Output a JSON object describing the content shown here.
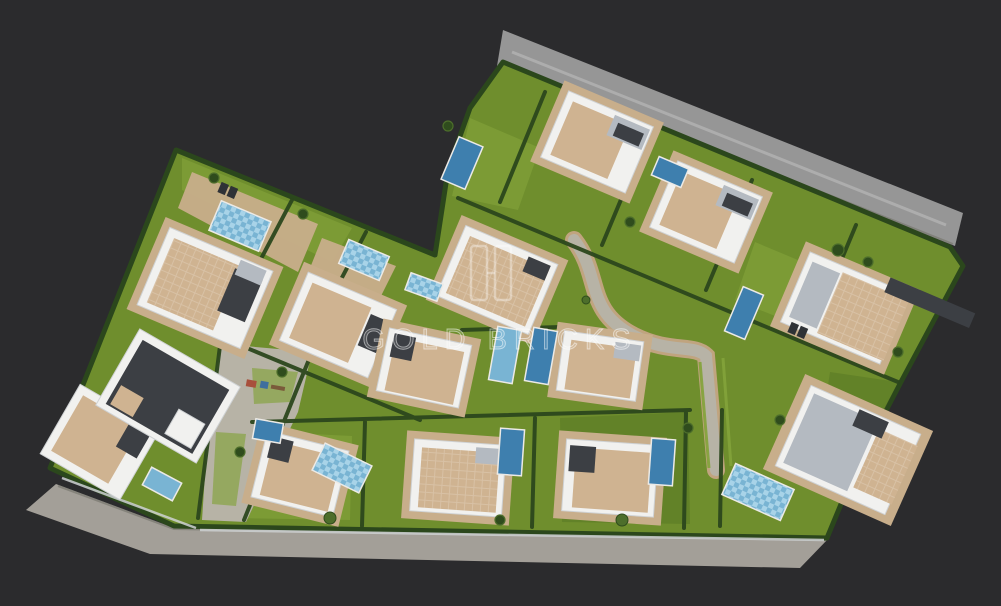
{
  "watermark": {
    "brand_text": "GOLD BRICKS",
    "emblem": "gold-bricks-monogram"
  },
  "scene": {
    "type": "aerial-3d-architectural-render",
    "subject": "Bird's-eye render of a gated residential development of modern white villas",
    "features": [
      "white villas with tiled terraces",
      "private swimming pools",
      "lawned gardens with hedge borders",
      "perimeter roads",
      "central pedestrian walkway",
      "playground",
      "palm trees"
    ],
    "villas_visible": 14,
    "pools_visible": 14
  },
  "colors": {
    "background": "#2b2b2d",
    "road": "#969696",
    "roadWarm": "#a39f98",
    "roadEdge": "#77776f",
    "grass": "#6f8e2d",
    "grassLight": "#83a33b",
    "grassDark": "#5a7a24",
    "hedge": "#2b471c",
    "white": "#f1f1ef",
    "whiteShade": "#cfd2d4",
    "beige": "#cfb391",
    "deck": "#c8ae8b",
    "gray": "#b4bac1",
    "dark": "#3c3f44",
    "pool": "#3e7fae",
    "poolLight": "#79b4d3",
    "poolPale": "#a8d3e8",
    "path": "#b7b3a6",
    "pathEdge": "#c0a47f",
    "tree": "#2f4c1d",
    "treeLight": "#4d6e2b",
    "watermark": "rgba(255,255,255,0.55)"
  }
}
